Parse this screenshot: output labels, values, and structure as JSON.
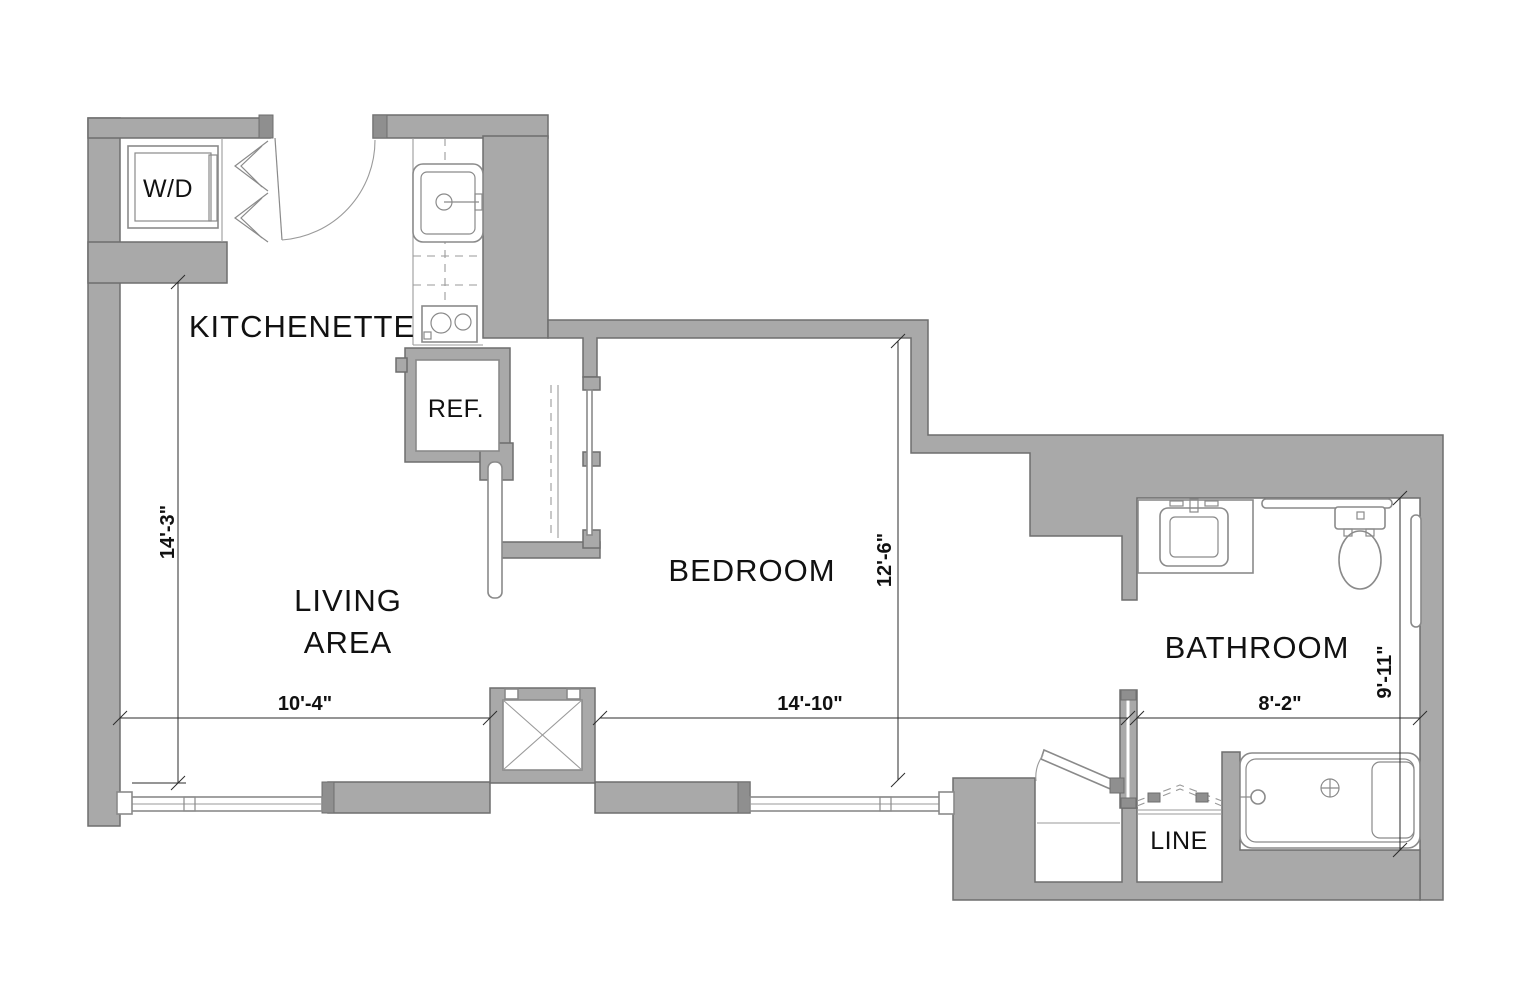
{
  "plan": {
    "type": "apartment-floor-plan",
    "rooms": {
      "kitchenette": {
        "label": "KITCHENETTE"
      },
      "living": {
        "line1": "LIVING",
        "line2": "AREA"
      },
      "bedroom": {
        "label": "BEDROOM"
      },
      "bathroom": {
        "label": "BATHROOM"
      }
    },
    "fixtures": {
      "washer_dryer": {
        "label": "W/D"
      },
      "refrigerator": {
        "label": "REF."
      },
      "linen_closet": {
        "label": "LINE"
      }
    },
    "dimensions": {
      "living_height": "14'-3\"",
      "living_width": "10'-4\"",
      "bedroom_width": "14'-10\"",
      "bedroom_height": "12'-6\"",
      "bathroom_width": "8'-2\"",
      "bathroom_height": "9'-11\""
    },
    "colors": {
      "wall_fill": "#a9a9a9",
      "wall_outline": "#6e6e6e",
      "fixture_line": "#8a8a8a",
      "dimension_line": "#2b2b2b",
      "text": "#111111",
      "background": "#ffffff"
    }
  }
}
